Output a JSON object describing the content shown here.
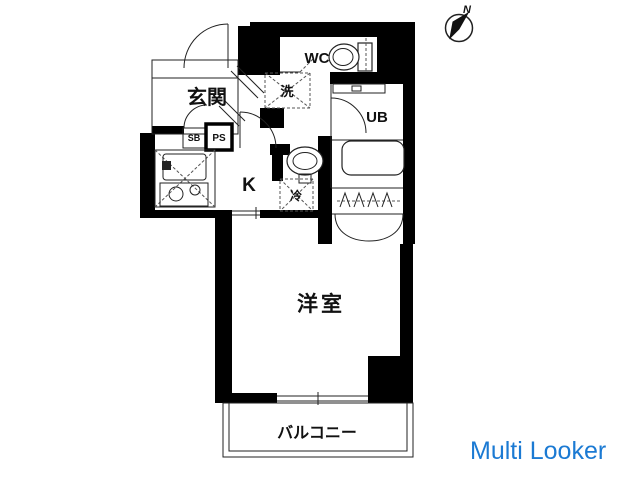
{
  "app": {
    "watermark": "Multi Looker",
    "watermark_color": "#1b7ad3"
  },
  "compass": {
    "north_label": "N"
  },
  "floorplan": {
    "wall_color": "#000000",
    "labels": {
      "genkan": "玄関",
      "wc": "WC",
      "washer": "洗",
      "ub": "UB",
      "sb": "SB",
      "ps": "PS",
      "kitchen": "K",
      "fridge": "冷",
      "western_room": "洋室",
      "balcony": "バルコニー"
    }
  }
}
